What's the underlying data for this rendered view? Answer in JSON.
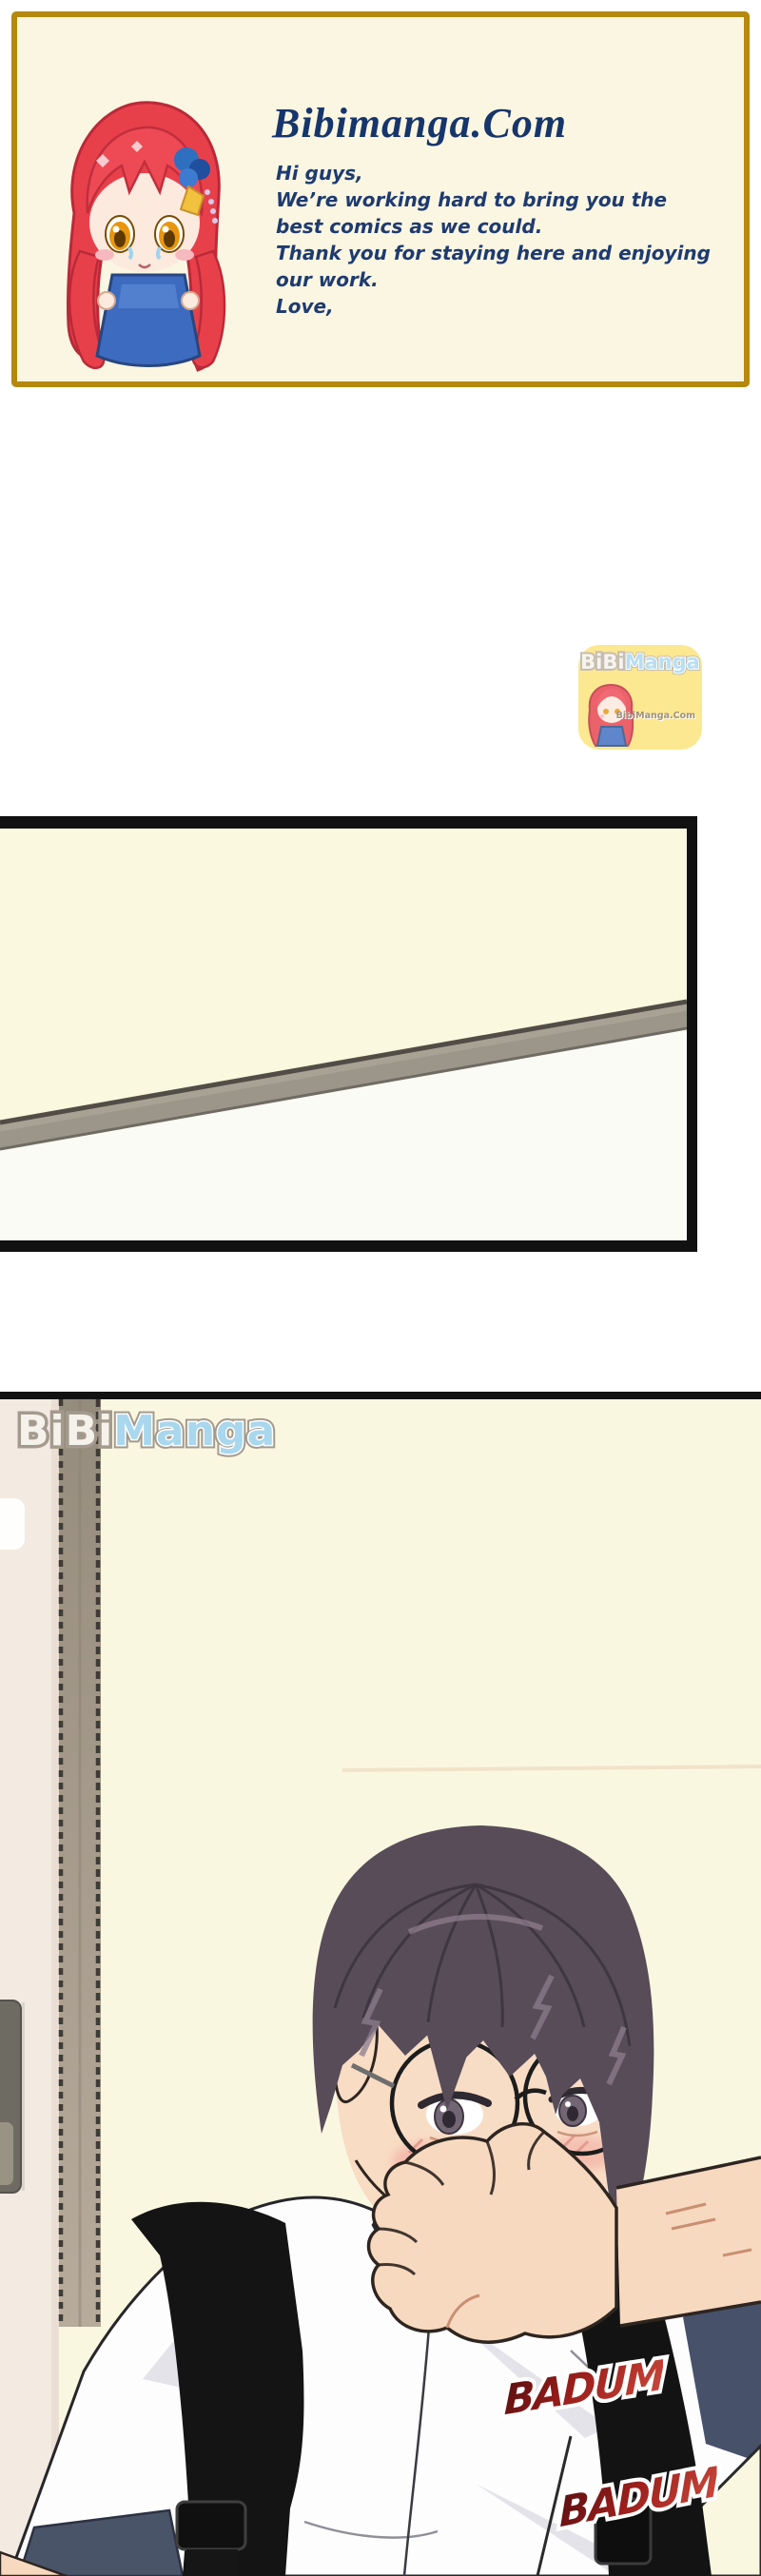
{
  "notice": {
    "title": "Bibimanga.Com",
    "lines": [
      "Hi guys,",
      "We’re working hard to bring you the",
      "best comics as we could.",
      "Thank you for staying here and enjoying",
      "our work.",
      "Love,"
    ]
  },
  "watermark": {
    "bibi": "BiBi",
    "manga": "Manga"
  },
  "badge": {
    "bibi": "BiBi",
    "manga": "Manga",
    "site": "BibiManga.Com"
  },
  "sfx": {
    "badum_top": "BADUM",
    "badum_bottom": "BADUM"
  },
  "colors": {
    "notice_border": "#B5880E",
    "notice_bg": "#FBF6E2",
    "title_navy": "#16356B",
    "panel_cream": "#FAF7E1",
    "bar_gray": "#9C968A",
    "sfx_red": "#A3201C",
    "watermark_blue": "#A9D7EE",
    "badge_yellow": "#FBE37A"
  }
}
